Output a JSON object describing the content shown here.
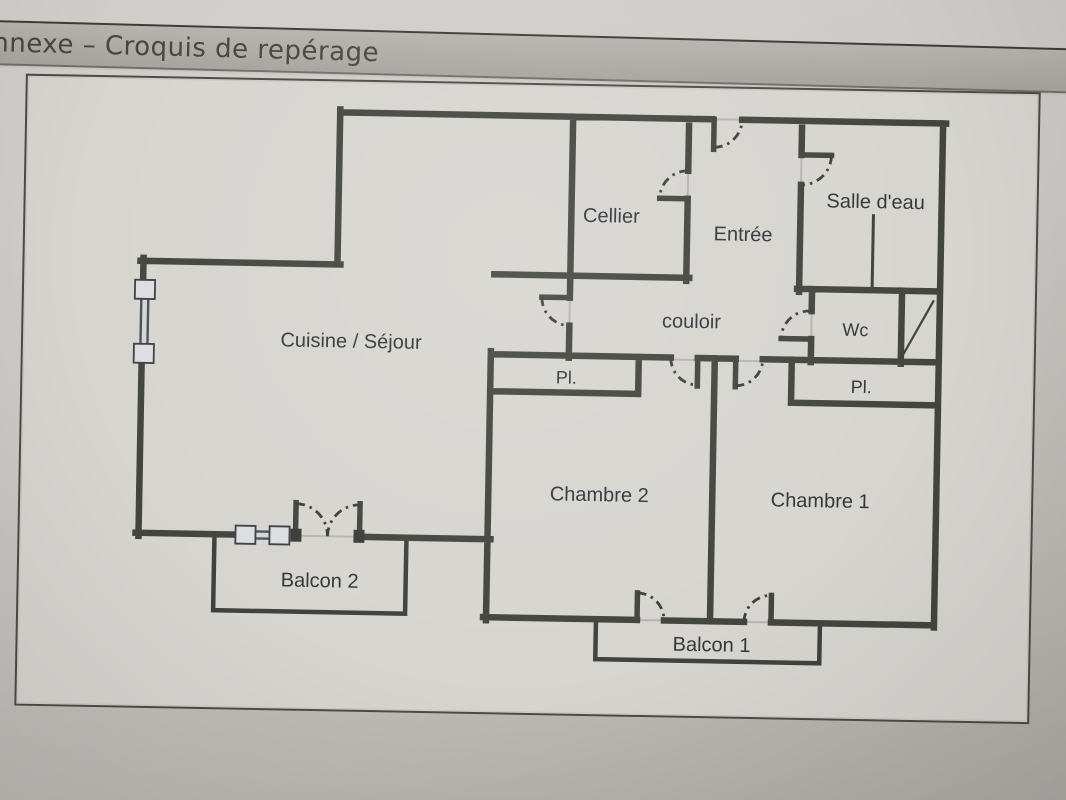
{
  "banner": {
    "title": "nnexe – Croquis de repérage"
  },
  "floorplan": {
    "type": "apartment-floor-plan-sketch",
    "rooms": [
      {
        "id": "cellier",
        "label": "Cellier",
        "x": 608,
        "y": 214
      },
      {
        "id": "entree",
        "label": "Entrée",
        "x": 740,
        "y": 230
      },
      {
        "id": "salle-deau",
        "label": "Salle d'eau",
        "x": 872,
        "y": 195
      },
      {
        "id": "couloir",
        "label": "couloir",
        "x": 690,
        "y": 318
      },
      {
        "id": "wc",
        "label": "Wc",
        "x": 854,
        "y": 324
      },
      {
        "id": "cuisine-sejour",
        "label": "Cuisine / Séjour",
        "x": 350,
        "y": 344
      },
      {
        "id": "placard-couloir",
        "label": "Pl.",
        "x": 566,
        "y": 377
      },
      {
        "id": "placard-chambre1",
        "label": "Pl.",
        "x": 861,
        "y": 381
      },
      {
        "id": "chambre-2",
        "label": "Chambre 2",
        "x": 601,
        "y": 493
      },
      {
        "id": "chambre-1",
        "label": "Chambre 1",
        "x": 822,
        "y": 495
      },
      {
        "id": "balcon-2",
        "label": "Balcon 2",
        "x": 323,
        "y": 584
      },
      {
        "id": "balcon-1",
        "label": "Balcon 1",
        "x": 716,
        "y": 641
      }
    ],
    "colors": {
      "wall": "#43463f",
      "paper": "#d7d5d0",
      "page_background": "#c4c1bc",
      "banner_background": "#aeaba5",
      "window_glazing": "#4a5161",
      "label_text": "#33363b",
      "sheet_border": "#4e4b46",
      "threshold": "#b4b4b2"
    }
  }
}
